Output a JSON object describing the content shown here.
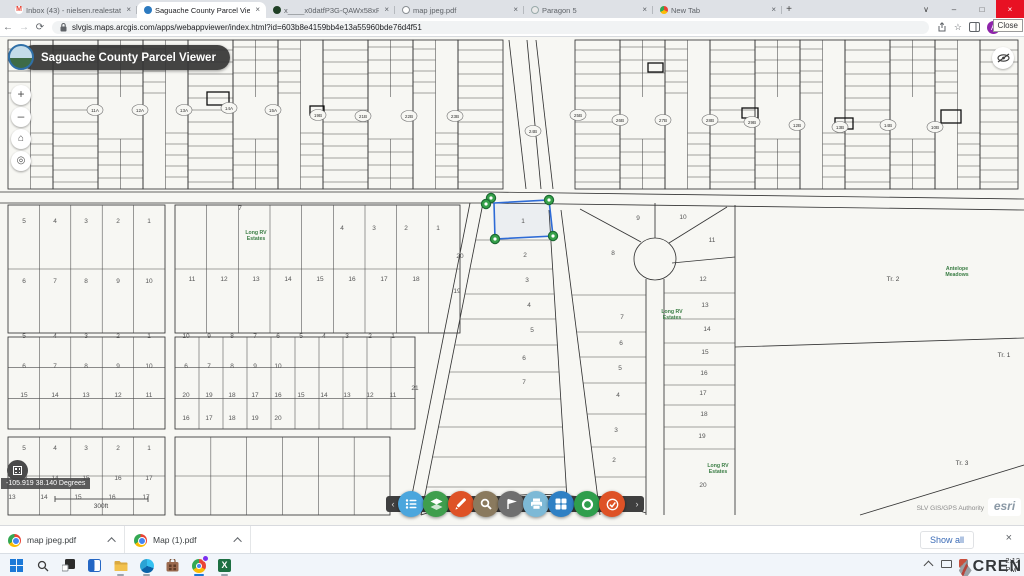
{
  "browser": {
    "tabs": [
      {
        "title": "Inbox (43) - nielsen.realestate@",
        "icon": "gmail-favicon",
        "active": false
      },
      {
        "title": "Saguache County Parcel Viewer",
        "icon": "arcgis-favicon",
        "active": true
      },
      {
        "title": "x____x0datfP3G-QAWx58xR655",
        "icon": "app-favicon",
        "active": false
      },
      {
        "title": "map jpeg.pdf",
        "icon": "globe-favicon",
        "active": false
      },
      {
        "title": "Paragon 5",
        "icon": "paragon-favicon",
        "active": false
      },
      {
        "title": "New Tab",
        "icon": "chrome-favicon",
        "active": false
      }
    ],
    "close_tooltip": "Close",
    "url": "slvgis.maps.arcgis.com/apps/webappviewer/index.html?id=603b8e4159bb4e13a55960bde76d4f51"
  },
  "app": {
    "title": "Saguache County Parcel Viewer"
  },
  "map": {
    "coordinates": "-105.919 38.140 Degrees",
    "scale": "300ft",
    "attribution": "SLV GIS/GPS Authority",
    "esri": "esri",
    "selected_parcel": "1",
    "ovals": [
      {
        "t": "11A",
        "x": 95,
        "y": 73
      },
      {
        "t": "12A",
        "x": 140,
        "y": 73
      },
      {
        "t": "13A",
        "x": 184,
        "y": 73
      },
      {
        "t": "14A",
        "x": 229,
        "y": 71
      },
      {
        "t": "15A",
        "x": 273,
        "y": 73
      },
      {
        "t": "19B",
        "x": 318,
        "y": 78
      },
      {
        "t": "21B",
        "x": 363,
        "y": 79
      },
      {
        "t": "22B",
        "x": 409,
        "y": 79
      },
      {
        "t": "23B",
        "x": 455,
        "y": 79
      },
      {
        "t": "24B",
        "x": 533,
        "y": 94
      },
      {
        "t": "25B",
        "x": 578,
        "y": 78
      },
      {
        "t": "26B",
        "x": 620,
        "y": 83
      },
      {
        "t": "27B",
        "x": 663,
        "y": 83
      },
      {
        "t": "28B",
        "x": 710,
        "y": 83
      },
      {
        "t": "29B",
        "x": 752,
        "y": 85
      },
      {
        "t": "12B",
        "x": 797,
        "y": 88
      },
      {
        "t": "13B",
        "x": 840,
        "y": 90
      },
      {
        "t": "14B",
        "x": 888,
        "y": 88
      },
      {
        "t": "10B",
        "x": 935,
        "y": 90
      }
    ],
    "numbers": [
      {
        "t": "5",
        "x": 24,
        "y": 186
      },
      {
        "t": "4",
        "x": 55,
        "y": 186
      },
      {
        "t": "3",
        "x": 86,
        "y": 186
      },
      {
        "t": "2",
        "x": 118,
        "y": 186
      },
      {
        "t": "1",
        "x": 149,
        "y": 186
      },
      {
        "t": "6",
        "x": 24,
        "y": 246
      },
      {
        "t": "7",
        "x": 55,
        "y": 246
      },
      {
        "t": "8",
        "x": 86,
        "y": 246
      },
      {
        "t": "9",
        "x": 118,
        "y": 246
      },
      {
        "t": "10",
        "x": 149,
        "y": 246
      },
      {
        "t": "7",
        "x": 240,
        "y": 173
      },
      {
        "t": "4",
        "x": 342,
        "y": 193
      },
      {
        "t": "3",
        "x": 374,
        "y": 193
      },
      {
        "t": "2",
        "x": 406,
        "y": 193
      },
      {
        "t": "1",
        "x": 438,
        "y": 193
      },
      {
        "t": "20",
        "x": 460,
        "y": 221
      },
      {
        "t": "19",
        "x": 457,
        "y": 256
      },
      {
        "t": "11",
        "x": 192,
        "y": 244
      },
      {
        "t": "12",
        "x": 224,
        "y": 244
      },
      {
        "t": "13",
        "x": 256,
        "y": 244
      },
      {
        "t": "14",
        "x": 288,
        "y": 244
      },
      {
        "t": "15",
        "x": 320,
        "y": 244
      },
      {
        "t": "16",
        "x": 352,
        "y": 244
      },
      {
        "t": "17",
        "x": 384,
        "y": 244
      },
      {
        "t": "18",
        "x": 416,
        "y": 244
      },
      {
        "t": "5",
        "x": 24,
        "y": 301
      },
      {
        "t": "4",
        "x": 55,
        "y": 301
      },
      {
        "t": "3",
        "x": 86,
        "y": 301
      },
      {
        "t": "2",
        "x": 118,
        "y": 301
      },
      {
        "t": "1",
        "x": 149,
        "y": 301
      },
      {
        "t": "6",
        "x": 24,
        "y": 331
      },
      {
        "t": "7",
        "x": 55,
        "y": 331
      },
      {
        "t": "8",
        "x": 86,
        "y": 331
      },
      {
        "t": "9",
        "x": 118,
        "y": 331
      },
      {
        "t": "10",
        "x": 149,
        "y": 331
      },
      {
        "t": "15",
        "x": 24,
        "y": 360
      },
      {
        "t": "14",
        "x": 55,
        "y": 360
      },
      {
        "t": "13",
        "x": 86,
        "y": 360
      },
      {
        "t": "12",
        "x": 118,
        "y": 360
      },
      {
        "t": "11",
        "x": 149,
        "y": 360
      },
      {
        "t": "10",
        "x": 186,
        "y": 301
      },
      {
        "t": "9",
        "x": 209,
        "y": 301
      },
      {
        "t": "8",
        "x": 232,
        "y": 301
      },
      {
        "t": "7",
        "x": 255,
        "y": 301
      },
      {
        "t": "6",
        "x": 278,
        "y": 301
      },
      {
        "t": "5",
        "x": 301,
        "y": 301
      },
      {
        "t": "4",
        "x": 324,
        "y": 301
      },
      {
        "t": "3",
        "x": 347,
        "y": 301
      },
      {
        "t": "2",
        "x": 370,
        "y": 301
      },
      {
        "t": "1",
        "x": 393,
        "y": 301
      },
      {
        "t": "6",
        "x": 186,
        "y": 331
      },
      {
        "t": "7",
        "x": 209,
        "y": 331
      },
      {
        "t": "8",
        "x": 232,
        "y": 331
      },
      {
        "t": "9",
        "x": 255,
        "y": 331
      },
      {
        "t": "10",
        "x": 278,
        "y": 331
      },
      {
        "t": "20",
        "x": 186,
        "y": 360
      },
      {
        "t": "19",
        "x": 209,
        "y": 360
      },
      {
        "t": "18",
        "x": 232,
        "y": 360
      },
      {
        "t": "17",
        "x": 255,
        "y": 360
      },
      {
        "t": "16",
        "x": 278,
        "y": 360
      },
      {
        "t": "15",
        "x": 301,
        "y": 360
      },
      {
        "t": "14",
        "x": 324,
        "y": 360
      },
      {
        "t": "13",
        "x": 347,
        "y": 360
      },
      {
        "t": "12",
        "x": 370,
        "y": 360
      },
      {
        "t": "11",
        "x": 393,
        "y": 360
      },
      {
        "t": "16",
        "x": 186,
        "y": 383
      },
      {
        "t": "17",
        "x": 209,
        "y": 383
      },
      {
        "t": "18",
        "x": 232,
        "y": 383
      },
      {
        "t": "19",
        "x": 255,
        "y": 383
      },
      {
        "t": "20",
        "x": 278,
        "y": 383
      },
      {
        "t": "21",
        "x": 415,
        "y": 353
      },
      {
        "t": "5",
        "x": 24,
        "y": 413
      },
      {
        "t": "4",
        "x": 55,
        "y": 413
      },
      {
        "t": "3",
        "x": 86,
        "y": 413
      },
      {
        "t": "2",
        "x": 118,
        "y": 413
      },
      {
        "t": "1",
        "x": 149,
        "y": 413
      },
      {
        "t": "13",
        "x": 24,
        "y": 443
      },
      {
        "t": "14",
        "x": 55,
        "y": 443
      },
      {
        "t": "15",
        "x": 86,
        "y": 443
      },
      {
        "t": "16",
        "x": 118,
        "y": 443
      },
      {
        "t": "17",
        "x": 149,
        "y": 443
      },
      {
        "t": "13",
        "x": 12,
        "y": 462
      },
      {
        "t": "14",
        "x": 44,
        "y": 462
      },
      {
        "t": "15",
        "x": 78,
        "y": 462
      },
      {
        "t": "16",
        "x": 112,
        "y": 462
      },
      {
        "t": "17",
        "x": 146,
        "y": 462
      },
      {
        "t": "1",
        "x": 523,
        "y": 186
      },
      {
        "t": "2",
        "x": 525,
        "y": 220
      },
      {
        "t": "3",
        "x": 527,
        "y": 245
      },
      {
        "t": "4",
        "x": 529,
        "y": 270
      },
      {
        "t": "5",
        "x": 532,
        "y": 295
      },
      {
        "t": "6",
        "x": 524,
        "y": 323
      },
      {
        "t": "7",
        "x": 524,
        "y": 347
      },
      {
        "t": "8",
        "x": 613,
        "y": 218
      },
      {
        "t": "9",
        "x": 638,
        "y": 183
      },
      {
        "t": "10",
        "x": 683,
        "y": 182
      },
      {
        "t": "11",
        "x": 712,
        "y": 205
      },
      {
        "t": "7",
        "x": 622,
        "y": 282
      },
      {
        "t": "6",
        "x": 621,
        "y": 308
      },
      {
        "t": "5",
        "x": 620,
        "y": 333
      },
      {
        "t": "4",
        "x": 618,
        "y": 360
      },
      {
        "t": "3",
        "x": 616,
        "y": 395
      },
      {
        "t": "2",
        "x": 614,
        "y": 425
      },
      {
        "t": "12",
        "x": 703,
        "y": 244
      },
      {
        "t": "13",
        "x": 705,
        "y": 270
      },
      {
        "t": "14",
        "x": 707,
        "y": 294
      },
      {
        "t": "15",
        "x": 705,
        "y": 317
      },
      {
        "t": "16",
        "x": 704,
        "y": 338
      },
      {
        "t": "17",
        "x": 703,
        "y": 358
      },
      {
        "t": "18",
        "x": 704,
        "y": 379
      },
      {
        "t": "19",
        "x": 702,
        "y": 401
      },
      {
        "t": "20",
        "x": 703,
        "y": 450
      }
    ],
    "tracts": [
      {
        "t": "Tr. 2",
        "x": 893,
        "y": 244
      },
      {
        "t": "Tr. 1",
        "x": 1004,
        "y": 320
      },
      {
        "t": "Tr. 3",
        "x": 962,
        "y": 428
      }
    ],
    "green_labels": [
      {
        "lines": [
          "Long RV",
          "Estates"
        ],
        "x": 256,
        "y": 197
      },
      {
        "lines": [
          "Long RV",
          "Estates"
        ],
        "x": 672,
        "y": 276
      },
      {
        "lines": [
          "Long RV",
          "Estates"
        ],
        "x": 718,
        "y": 430
      },
      {
        "lines": [
          "Antelope",
          "Meadows"
        ],
        "x": 957,
        "y": 233
      }
    ]
  },
  "toolbar": {
    "buttons": [
      {
        "name": "legend",
        "color": "#4ba6dd"
      },
      {
        "name": "layers",
        "color": "#3f9e4d"
      },
      {
        "name": "draw",
        "color": "#de5226"
      },
      {
        "name": "search",
        "color": "#8a7a5e"
      },
      {
        "name": "near-me",
        "color": "#6f6f6f"
      },
      {
        "name": "print",
        "color": "#7db9d6"
      },
      {
        "name": "basemap",
        "color": "#2f80c4"
      },
      {
        "name": "measure",
        "color": "#2f9e4d"
      },
      {
        "name": "select",
        "color": "#de5226"
      }
    ]
  },
  "downloads": {
    "items": [
      {
        "name": "map jpeg.pdf"
      },
      {
        "name": "Map (1).pdf"
      }
    ],
    "show_all": "Show all"
  },
  "taskbar": {
    "time": "2:12 PM",
    "watermark": "CREN"
  }
}
